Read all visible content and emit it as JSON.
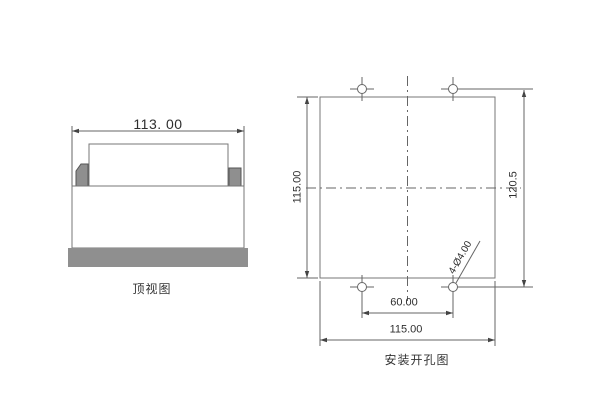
{
  "page": {
    "background": "#ffffff"
  },
  "colors": {
    "line": "#666666",
    "gray_fill": "#8f8f8f",
    "text": "#2e2e2e"
  },
  "top_view": {
    "width_dim": "113. 00",
    "caption": "顶视图"
  },
  "mounting_hole": {
    "left_height_dim": "115.00",
    "right_height_dim": "120.5",
    "hole_spacing_dim": "60.00",
    "bottom_width_dim": "115.00",
    "hole_callout": "4-Ø4.00",
    "caption": "安装开孔图"
  }
}
